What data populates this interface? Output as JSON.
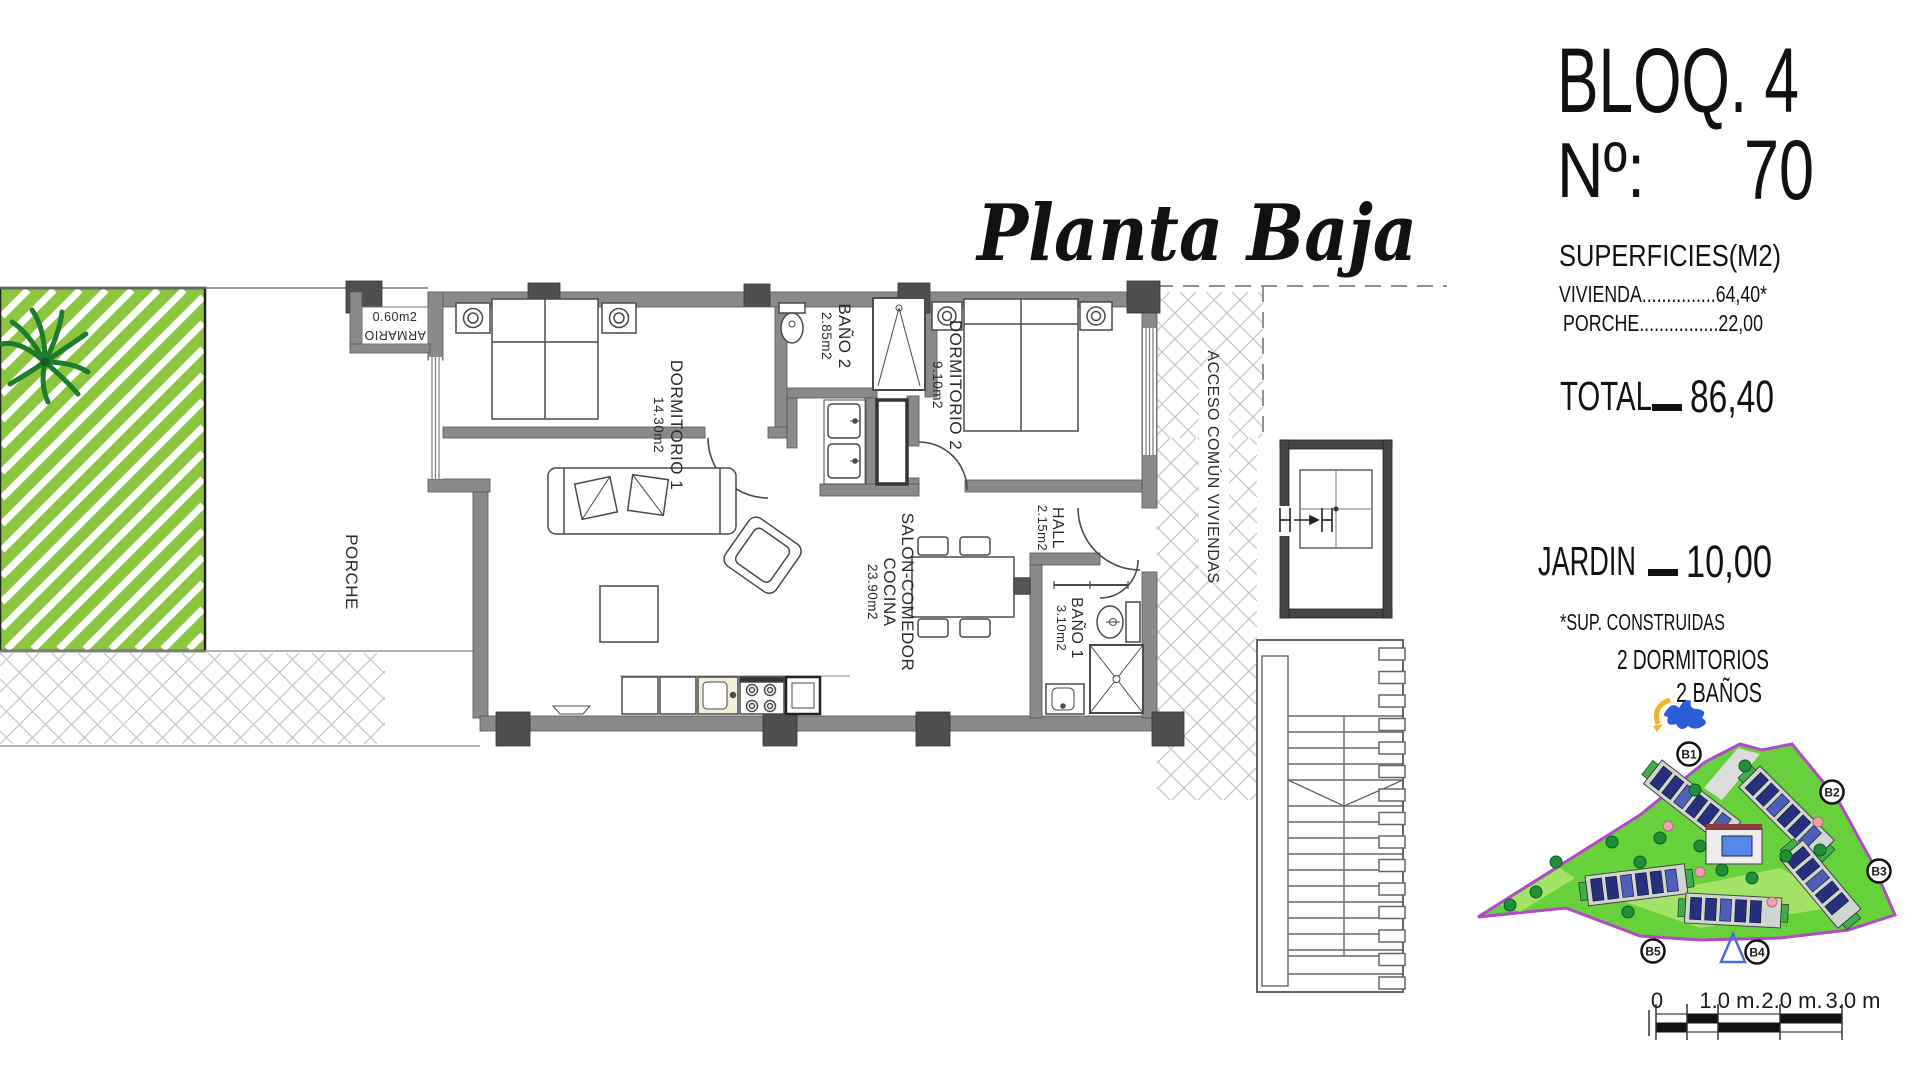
{
  "plan": {
    "script_title": "Planta Baja",
    "bloq": "BLOQ. 4",
    "num_label": "Nº:",
    "num_value": "70",
    "surfaces_title": "SUPERFICIES(M2)",
    "vivienda_line": "VIVIENDA...............64,40*",
    "porche_line": "PORCHE................22,00",
    "total_label": "TOTAL",
    "total_value": "86,40",
    "jardin_label": "JARDIN",
    "jardin_value": "10,00",
    "footnote": "*SUP. CONSTRUIDAS",
    "feature_1": "2 DORMITORIOS",
    "feature_2": "2 BAÑOS"
  },
  "rooms": {
    "dormitorio1": {
      "name": "DORMITORIO 1",
      "area": "14.30m2"
    },
    "bano2": {
      "name": "BAÑO 2",
      "area": "2.85m2"
    },
    "dormitorio2": {
      "name": "DORMITORIO 2",
      "area": "9.10m2"
    },
    "salon": {
      "name": "SALON-COMEDOR",
      "name2": "COCINA",
      "area": "23.90m2"
    },
    "hall": {
      "name": "HALL",
      "area": "2.15m2"
    },
    "bano1": {
      "name": "BAÑO 1",
      "area": "3.10m2"
    },
    "porche": {
      "name": "PORCHE"
    },
    "armario": {
      "name": "ARMARIO",
      "area": "0.60m2"
    },
    "acceso": {
      "name": "ACCESO COMÚN VIVIENDAS"
    }
  },
  "site_plan": {
    "building_labels": [
      "B1",
      "B2",
      "B3",
      "B4",
      "B5"
    ]
  },
  "scale_bar": {
    "labels": [
      "0",
      "1.0 m.",
      "2.0 m.",
      "3.0 m"
    ],
    "ticks_m": [
      0,
      0.5,
      1,
      2,
      3
    ],
    "px_per_m": 62,
    "origin_x": 1656
  },
  "colors": {
    "wall": "#8a8a8a",
    "wall_dark": "#4f4f4f",
    "line": "#4a4a4a",
    "garden_green": "#8CC63F",
    "palm_green": "#1e7c2d",
    "hatch_gray": "#c9c9c9",
    "site_green": "#66d13a",
    "site_green_light": "#a3e468",
    "site_border_purple": "#b349c8",
    "building_blue": "#27307e",
    "building_blue2": "#4d5fb8",
    "pool_blue": "#5588e8",
    "tree_green": "#1f8f3a",
    "tree_pink": "#f2a0ac",
    "compass_blue": "#2b5fd9",
    "compass_yellow": "#f0b429"
  }
}
